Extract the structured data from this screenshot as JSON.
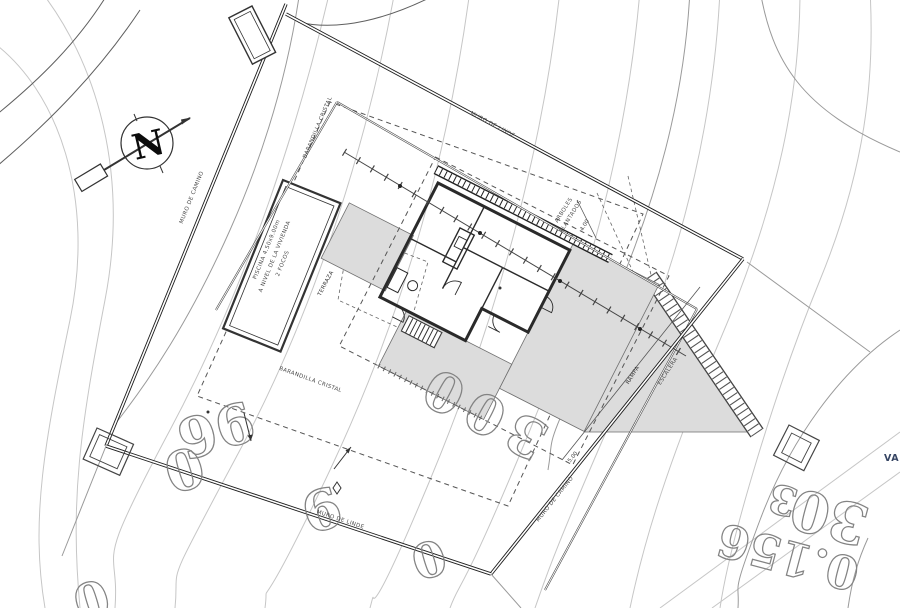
{
  "drawing": {
    "labels": {
      "muro_de_camino": "MURO DE CAMINO",
      "muro_de_linde": "MURO DE LINDE",
      "barandilla_cristal": "BARANDILLA CRISTAL",
      "terraza": "TERRAZA",
      "rampa": "RAMPA",
      "escalera": "ESCALERA",
      "arboles_1": "ARBOLES",
      "arboles_2": "PLANTADOS",
      "va_partial": "VA",
      "north": "N"
    },
    "pool": {
      "line1": "PISCINA 4.50x9.00m",
      "line2": "A NIVEL DE LA VIVIENDA",
      "line3": "2 FOCOS"
    },
    "dimensions": {
      "dim_4": "4.00",
      "dim_5": "5.00"
    },
    "parcel_numbers": {
      "n96": "96",
      "n0a": "0",
      "n9": "9",
      "n300": "300",
      "n0b": "0",
      "n0c": "0",
      "n156": "0.156",
      "n30": "30",
      "n3": "3"
    },
    "colors": {
      "contour_light": "#c6c6c6",
      "contour_dark": "#9a9a9a",
      "wall": "#1d1d1d",
      "terrace_fill": "#dcdcdc",
      "numeral_stroke": "#838383",
      "va_text": "#364563"
    }
  }
}
